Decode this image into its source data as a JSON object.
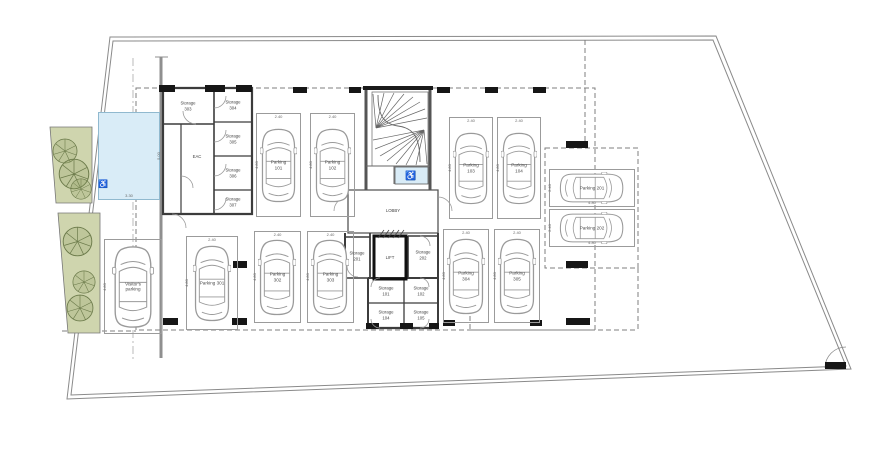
{
  "rooms": {
    "eac": "EAC",
    "lift": "LIFT",
    "lobby": "LOBBY"
  },
  "storage": {
    "left_block": [
      {
        "label": "Storage\n303"
      },
      {
        "label": "Storage\n304"
      },
      {
        "label": "Storage\n305"
      },
      {
        "label": "Storage\n306"
      },
      {
        "label": "Storage\n307"
      }
    ],
    "center_block": [
      {
        "label": "Storage\n201"
      },
      {
        "label": "Storage\n202"
      },
      {
        "label": "Storage\n101"
      },
      {
        "label": "Storage\n102"
      },
      {
        "label": "Storage\n104"
      },
      {
        "label": "Storage\n105"
      }
    ]
  },
  "parking": {
    "spots": [
      {
        "id": "101",
        "label": "Parking 101"
      },
      {
        "id": "102",
        "label": "Parking 102"
      },
      {
        "id": "103",
        "label": "Parking 103"
      },
      {
        "id": "104",
        "label": "Parking 104"
      },
      {
        "id": "201",
        "label": "Parking 201"
      },
      {
        "id": "202",
        "label": "Parking 202"
      },
      {
        "id": "301",
        "label": "Parking 301"
      },
      {
        "id": "302",
        "label": "Parking 302"
      },
      {
        "id": "303",
        "label": "Parking 303"
      },
      {
        "id": "304",
        "label": "Parking 304"
      },
      {
        "id": "305",
        "label": "Parking 305"
      },
      {
        "id": "visitor",
        "label": "Visitor's\nparking"
      }
    ],
    "dims": {
      "width": "2.40",
      "length": "4.80"
    },
    "accessible_dims": {
      "width": "3.30",
      "length": "5.00"
    }
  },
  "icons": {
    "wheelchair": "♿"
  },
  "colors": {
    "accessible_blue": "#d9ecf7",
    "landscape_green": "#cfd5ae",
    "wall": "#3c3c3c",
    "column": "#161616"
  }
}
